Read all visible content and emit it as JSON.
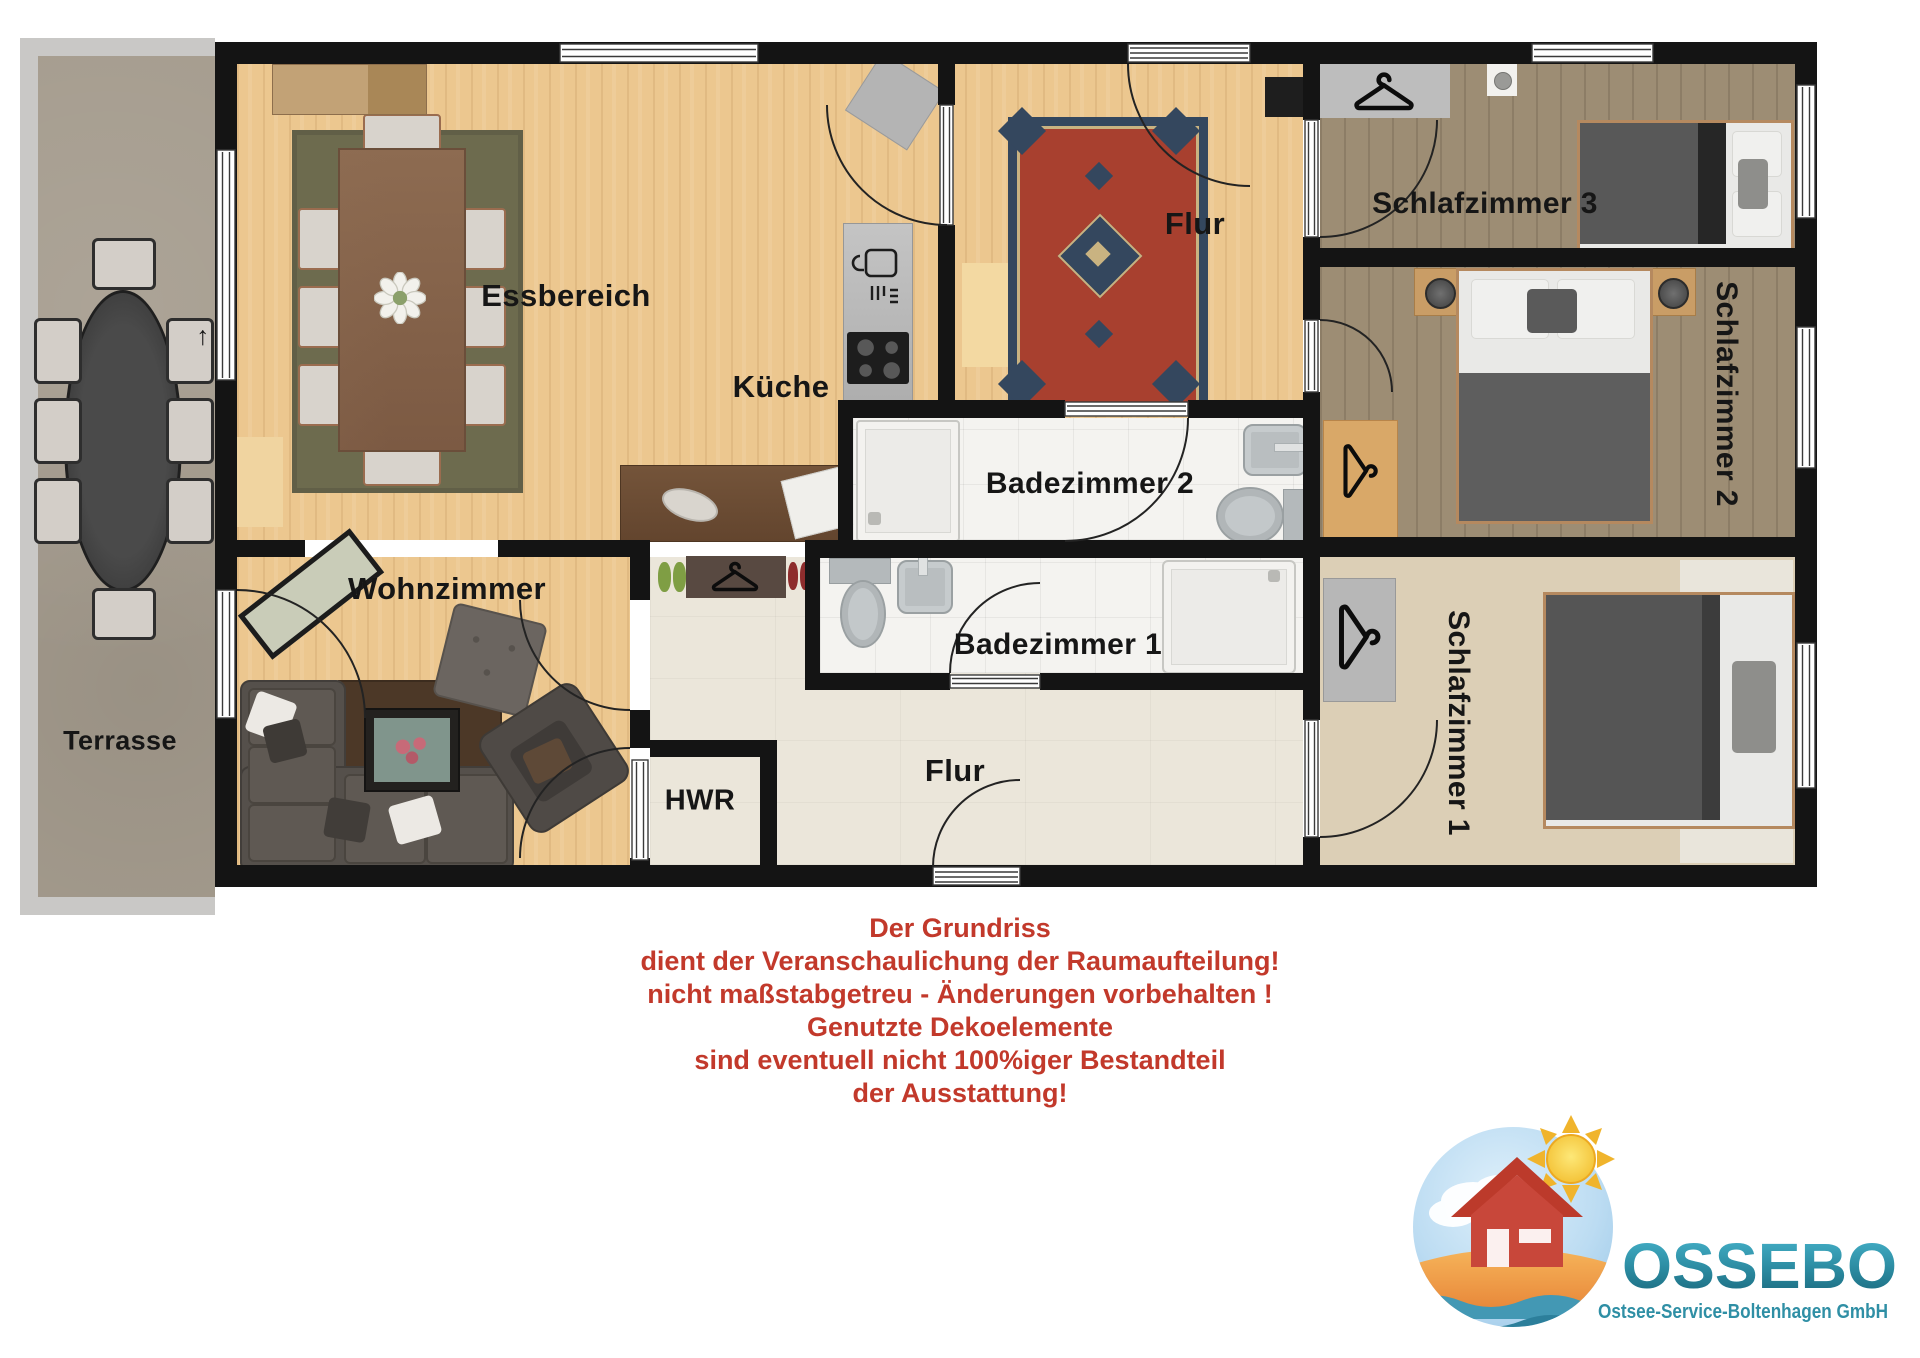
{
  "floorplan": {
    "rooms": {
      "terrasse": {
        "label": "Terrasse"
      },
      "essbereich": {
        "label": "Essbereich"
      },
      "kueche": {
        "label": "Küche"
      },
      "flur_oben": {
        "label": "Flur"
      },
      "schlafzimmer3": {
        "label": "Schlafzimmer 3"
      },
      "schlafzimmer2": {
        "label": "Schlafzimmer 2"
      },
      "schlafzimmer1": {
        "label": "Schlafzimmer 1"
      },
      "badezimmer2": {
        "label": "Badezimmer 2"
      },
      "badezimmer1": {
        "label": "Badezimmer 1"
      },
      "wohnzimmer": {
        "label": "Wohnzimmer"
      },
      "hwr": {
        "label": "HWR"
      },
      "flur_unten": {
        "label": "Flur"
      }
    },
    "north_arrow_glyph": "↑"
  },
  "disclaimer": {
    "color": "#c2392b",
    "lines": [
      "Der Grundriss",
      "dient der Veranschaulichung der Raumaufteilung!",
      "nicht maßstabgetreu - Änderungen vorbehalten !",
      "Genutzte Dekoelemente",
      "sind eventuell nicht 100%iger Bestandteil",
      "der Ausstattung!"
    ]
  },
  "logo": {
    "brand": "OSSEBO",
    "subtitle": "Ostsee-Service-Boltenhagen GmbH",
    "brand_color": "#2f8fa5",
    "subtitle_color": "#2f8fa5"
  },
  "colors": {
    "wall": "#141414",
    "wood_light": "#ecc78f",
    "wood_gray": "#9d8d74",
    "carpet": "#dccfb6",
    "tile_light": "#ebe6da",
    "bath_tile": "#f4f3f0",
    "terrace": "#a59c8e",
    "rug_olive": "#6d6b4e",
    "rug_persian_red": "#a8402f",
    "rug_persian_blue": "#34475e",
    "accent_red": "#c2392b",
    "logo_teal": "#2f8fa5"
  }
}
